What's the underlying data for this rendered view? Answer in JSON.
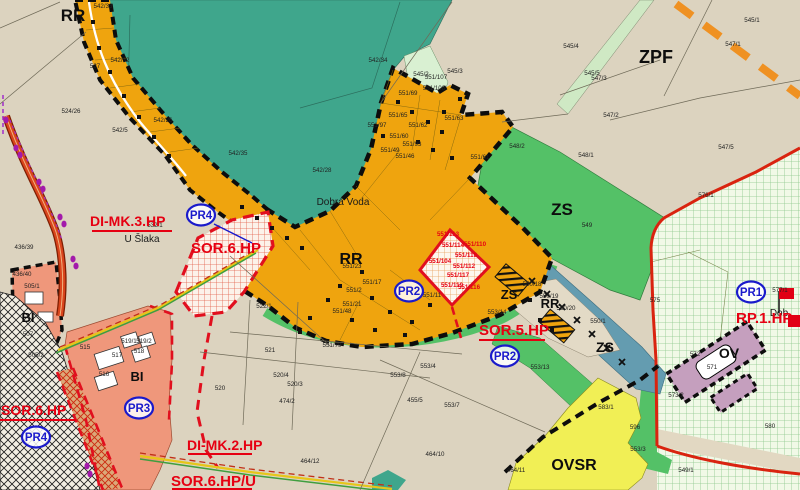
{
  "map": {
    "title": "zoning-plan-extract",
    "colors": {
      "background_beige": "#dcd3bf",
      "forest_teal": "#3fa68c",
      "settlement_orange": "#efa40e",
      "greenery_zs": "#54c167",
      "mint": "#d9f0d2",
      "grid_green_bg": "#f1f9e7",
      "housing_salmon": "#ef977b",
      "civic_yellow": "#f1ef55",
      "civic_mauve": "#c59fbe",
      "alley_bluegray": "#649cb0",
      "overlay_red": "#e60012",
      "marker_blue": "#1a1acb",
      "road_redorange": "#d9441c",
      "corridor_orange_dash": "#ef9122"
    },
    "zone_labels": [
      {
        "text": "RR",
        "x": 73,
        "y": 21,
        "size": 17
      },
      {
        "text": "ZPF",
        "x": 656,
        "y": 63,
        "size": 18
      },
      {
        "text": "ZS",
        "x": 562,
        "y": 215,
        "size": 17
      },
      {
        "text": "RR",
        "x": 351,
        "y": 264,
        "size": 16
      },
      {
        "text": "ZS",
        "x": 509,
        "y": 299,
        "size": 13
      },
      {
        "text": "RR",
        "x": 550,
        "y": 308,
        "size": 13
      },
      {
        "text": "ZS",
        "x": 605,
        "y": 352,
        "size": 14
      },
      {
        "text": "OVSR",
        "x": 574,
        "y": 470,
        "size": 16
      },
      {
        "text": "OV",
        "x": 729,
        "y": 358,
        "size": 14
      },
      {
        "text": "BI",
        "x": 28,
        "y": 322,
        "size": 13
      },
      {
        "text": "BI",
        "x": 137,
        "y": 381,
        "size": 13
      }
    ],
    "overlay_labels": [
      {
        "text": "DI-MK.3.HP",
        "x": 90,
        "y": 226,
        "size": 14
      },
      {
        "text": "SOR.6.HP",
        "x": 191,
        "y": 253,
        "size": 15
      },
      {
        "text": "SOR.5.HP",
        "x": 479,
        "y": 335,
        "size": 15
      },
      {
        "text": "RP.1.HP",
        "x": 736,
        "y": 323,
        "size": 15
      },
      {
        "text": "SOR.6.HP",
        "x": 1,
        "y": 415,
        "size": 14
      },
      {
        "text": "DI-MK.2.HP",
        "x": 187,
        "y": 450,
        "size": 14
      },
      {
        "text": "SOR.6.HP/U",
        "x": 171,
        "y": 486,
        "size": 15
      }
    ],
    "pr_markers": [
      {
        "label": "PR4",
        "x": 201,
        "y": 215
      },
      {
        "label": "PR2",
        "x": 409,
        "y": 291
      },
      {
        "label": "PR2",
        "x": 505,
        "y": 356
      },
      {
        "label": "PR1",
        "x": 751,
        "y": 292
      },
      {
        "label": "PR3",
        "x": 139,
        "y": 408
      },
      {
        "label": "PR4",
        "x": 36,
        "y": 437
      }
    ],
    "place_names": [
      {
        "text": "Dobrá Voda",
        "x": 343,
        "y": 205,
        "size": 10
      },
      {
        "text": "U Šlaka",
        "x": 142,
        "y": 242,
        "size": 10
      },
      {
        "text": "Dob",
        "x": 779,
        "y": 316,
        "size": 11
      }
    ],
    "parcel_labels": [
      {
        "text": "542/33",
        "x": 103,
        "y": 8
      },
      {
        "text": "527",
        "x": 95,
        "y": 68
      },
      {
        "text": "524/26",
        "x": 71,
        "y": 113
      },
      {
        "text": "542/5",
        "x": 120,
        "y": 132
      },
      {
        "text": "542/32",
        "x": 120,
        "y": 62
      },
      {
        "text": "542/26",
        "x": 163,
        "y": 122
      },
      {
        "text": "542/34",
        "x": 378,
        "y": 62
      },
      {
        "text": "542/28",
        "x": 322,
        "y": 172
      },
      {
        "text": "542/35",
        "x": 238,
        "y": 155
      },
      {
        "text": "545/4",
        "x": 571,
        "y": 48
      },
      {
        "text": "545/1",
        "x": 752,
        "y": 22
      },
      {
        "text": "547/3",
        "x": 599,
        "y": 80
      },
      {
        "text": "547/2",
        "x": 611,
        "y": 117
      },
      {
        "text": "547/1",
        "x": 733,
        "y": 46
      },
      {
        "text": "547/5",
        "x": 726,
        "y": 149
      },
      {
        "text": "545/3",
        "x": 455,
        "y": 73
      },
      {
        "text": "545/5",
        "x": 592,
        "y": 75
      },
      {
        "text": "545/2",
        "x": 421,
        "y": 76
      },
      {
        "text": "551/69",
        "x": 408,
        "y": 95
      },
      {
        "text": "551/107",
        "x": 436,
        "y": 79
      },
      {
        "text": "551/108",
        "x": 434,
        "y": 90
      },
      {
        "text": "551/65",
        "x": 398,
        "y": 117
      },
      {
        "text": "551/63",
        "x": 454,
        "y": 120
      },
      {
        "text": "551/62",
        "x": 418,
        "y": 127
      },
      {
        "text": "551/97",
        "x": 377,
        "y": 127
      },
      {
        "text": "551/60",
        "x": 399,
        "y": 138
      },
      {
        "text": "551/93",
        "x": 412,
        "y": 146
      },
      {
        "text": "551/49",
        "x": 390,
        "y": 152
      },
      {
        "text": "551/46",
        "x": 405,
        "y": 158
      },
      {
        "text": "551/61",
        "x": 480,
        "y": 159
      },
      {
        "text": "551/23",
        "x": 352,
        "y": 268
      },
      {
        "text": "551/17",
        "x": 372,
        "y": 284
      },
      {
        "text": "551/2",
        "x": 354,
        "y": 292
      },
      {
        "text": "551/21",
        "x": 352,
        "y": 306
      },
      {
        "text": "551/48",
        "x": 342,
        "y": 313
      },
      {
        "text": "551/79",
        "x": 332,
        "y": 347
      },
      {
        "text": "551/11",
        "x": 432,
        "y": 297
      },
      {
        "text": "551/113",
        "x": 448,
        "y": 236,
        "red": true
      },
      {
        "text": "551/114",
        "x": 453,
        "y": 247,
        "red": true
      },
      {
        "text": "551/110",
        "x": 475,
        "y": 246,
        "red": true
      },
      {
        "text": "551/118",
        "x": 466,
        "y": 257,
        "red": true
      },
      {
        "text": "551/104",
        "x": 440,
        "y": 263,
        "red": true
      },
      {
        "text": "551/112",
        "x": 464,
        "y": 268,
        "red": true
      },
      {
        "text": "551/117",
        "x": 458,
        "y": 277,
        "red": true
      },
      {
        "text": "551/119",
        "x": 452,
        "y": 287,
        "red": true
      },
      {
        "text": "551/116",
        "x": 469,
        "y": 289,
        "red": true
      },
      {
        "text": "548/2",
        "x": 517,
        "y": 148
      },
      {
        "text": "548/1",
        "x": 586,
        "y": 157
      },
      {
        "text": "549",
        "x": 587,
        "y": 227
      },
      {
        "text": "550/18",
        "x": 532,
        "y": 286
      },
      {
        "text": "550/19",
        "x": 549,
        "y": 298
      },
      {
        "text": "550/20",
        "x": 566,
        "y": 310
      },
      {
        "text": "550/1",
        "x": 598,
        "y": 323
      },
      {
        "text": "553/14",
        "x": 497,
        "y": 314
      },
      {
        "text": "553/4",
        "x": 428,
        "y": 368
      },
      {
        "text": "553/13",
        "x": 540,
        "y": 369
      },
      {
        "text": "553/8",
        "x": 398,
        "y": 377
      },
      {
        "text": "553/7",
        "x": 452,
        "y": 407
      },
      {
        "text": "455/5",
        "x": 415,
        "y": 402
      },
      {
        "text": "474/2",
        "x": 287,
        "y": 403
      },
      {
        "text": "464/12",
        "x": 310,
        "y": 463
      },
      {
        "text": "464/10",
        "x": 435,
        "y": 456
      },
      {
        "text": "464/11",
        "x": 516,
        "y": 472
      },
      {
        "text": "522/1",
        "x": 264,
        "y": 308
      },
      {
        "text": "521",
        "x": 270,
        "y": 352
      },
      {
        "text": "520/4",
        "x": 281,
        "y": 377
      },
      {
        "text": "520/3",
        "x": 295,
        "y": 386
      },
      {
        "text": "520",
        "x": 220,
        "y": 390
      },
      {
        "text": "532/1",
        "x": 155,
        "y": 227
      },
      {
        "text": "505/1",
        "x": 32,
        "y": 288
      },
      {
        "text": "507",
        "x": 28,
        "y": 336
      },
      {
        "text": "505/2",
        "x": 36,
        "y": 357
      },
      {
        "text": "436/40",
        "x": 22,
        "y": 276
      },
      {
        "text": "436/39",
        "x": 24,
        "y": 249
      },
      {
        "text": "515",
        "x": 85,
        "y": 349
      },
      {
        "text": "519/1",
        "x": 129,
        "y": 343
      },
      {
        "text": "519/2",
        "x": 144,
        "y": 343
      },
      {
        "text": "517",
        "x": 117,
        "y": 357
      },
      {
        "text": "518",
        "x": 139,
        "y": 353
      },
      {
        "text": "516",
        "x": 104,
        "y": 376
      },
      {
        "text": "576/1",
        "x": 706,
        "y": 197
      },
      {
        "text": "575",
        "x": 655,
        "y": 302
      },
      {
        "text": "577/1",
        "x": 780,
        "y": 292
      },
      {
        "text": "572",
        "x": 695,
        "y": 356
      },
      {
        "text": "571",
        "x": 712,
        "y": 369
      },
      {
        "text": "573/2",
        "x": 676,
        "y": 397
      },
      {
        "text": "583/1",
        "x": 606,
        "y": 409
      },
      {
        "text": "580",
        "x": 770,
        "y": 428
      },
      {
        "text": "596",
        "x": 635,
        "y": 429
      },
      {
        "text": "553/3",
        "x": 638,
        "y": 451
      },
      {
        "text": "549/1",
        "x": 686,
        "y": 472
      }
    ],
    "symbols": {
      "tree_marks": [
        [
          532,
          281
        ],
        [
          547,
          294
        ],
        [
          562,
          307
        ],
        [
          577,
          320
        ],
        [
          592,
          334
        ],
        [
          607,
          348
        ],
        [
          622,
          362
        ]
      ],
      "cottages": [
        [
          398,
          102
        ],
        [
          412,
          112
        ],
        [
          428,
          122
        ],
        [
          442,
          132
        ],
        [
          418,
          142
        ],
        [
          433,
          150
        ],
        [
          452,
          158
        ],
        [
          383,
          136
        ],
        [
          444,
          112
        ],
        [
          460,
          99
        ],
        [
          340,
          286
        ],
        [
          362,
          272
        ],
        [
          372,
          298
        ],
        [
          390,
          312
        ],
        [
          412,
          322
        ],
        [
          430,
          305
        ],
        [
          310,
          318
        ],
        [
          328,
          300
        ],
        [
          300,
          332
        ],
        [
          352,
          320
        ],
        [
          375,
          330
        ],
        [
          405,
          335
        ],
        [
          93,
          22
        ],
        [
          99,
          48
        ],
        [
          110,
          72
        ],
        [
          124,
          96
        ],
        [
          139,
          117
        ],
        [
          154,
          137
        ],
        [
          169,
          156
        ],
        [
          242,
          207
        ],
        [
          257,
          218
        ],
        [
          272,
          228
        ],
        [
          287,
          238
        ],
        [
          302,
          248
        ],
        [
          540,
          320
        ],
        [
          552,
          330
        ],
        [
          530,
          300
        ]
      ],
      "purple_dots": [
        [
          6,
          120
        ],
        [
          16,
          148
        ],
        [
          20,
          155
        ],
        [
          39,
          182
        ],
        [
          43,
          189
        ],
        [
          60,
          217
        ],
        [
          64,
          224
        ],
        [
          73,
          259
        ],
        [
          76,
          266
        ],
        [
          87,
          466
        ],
        [
          90,
          474
        ]
      ],
      "flag_icon": {
        "x": 779,
        "y": 291
      }
    }
  }
}
